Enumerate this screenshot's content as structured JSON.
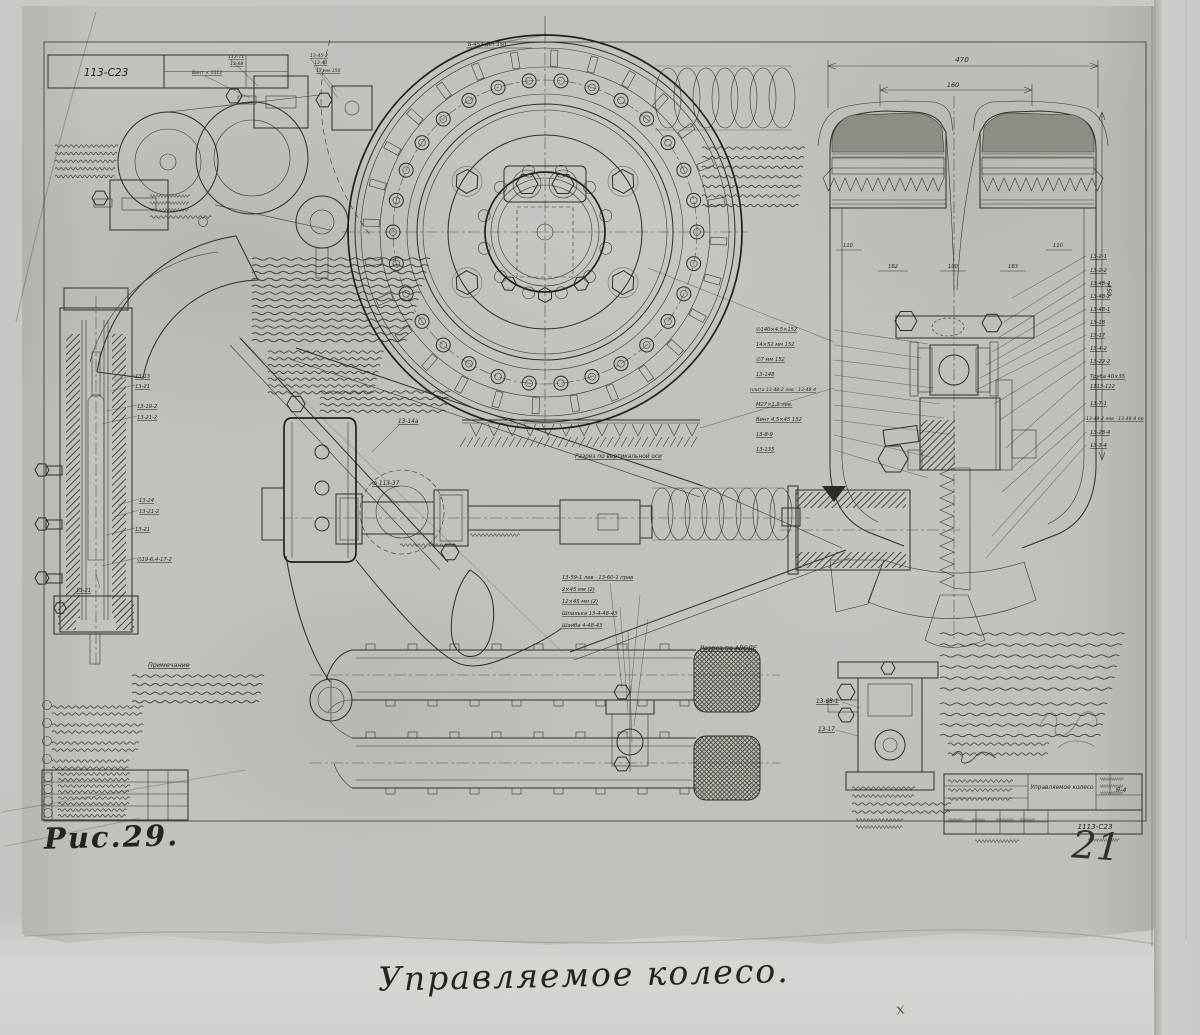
{
  "page": {
    "doc_number": "113-С23",
    "figure_label": "Рис.29.",
    "caption": "Управляемое колесо.",
    "page_number": "21",
    "corner_mark": "х",
    "top_note": "Б-453 дет 150"
  },
  "title_block": {
    "name": "Управляемое колесо",
    "group": "Я-4",
    "drawing_number": "1113-С23"
  },
  "dims": {
    "outer_width": "470",
    "inner_width": "160",
    "side_height": "450",
    "row": [
      "110",
      "162",
      "100",
      "163",
      "110"
    ]
  },
  "labels": {
    "section_abcde": "Разрез по АВСДЕ",
    "section_vertical": "Разрез по вертикальной оси",
    "note_title": "Примечание",
    "knuckle_part": "13-14а",
    "knuckle_dia": "∅ 113-37",
    "detail_part1": "13-68-1",
    "detail_part2": "13-17"
  },
  "callouts": {
    "top_left": [
      "113-71",
      "13-68",
      "Винт × 1312",
      "13-45-2",
      "13-43",
      "17 мм 150"
    ],
    "left_section": [
      "13-13",
      "13-21",
      "13-19-2",
      "13-21-2",
      "13-24",
      "13-21-2",
      "13-21",
      "∅19-6,4-17-2",
      "13-21"
    ],
    "hub_list": [
      "∅140×4,5×152",
      "14×52 мм 152",
      "∅7 мм 152",
      "13-148",
      "плита 13-48-2 лев · 13-48-4",
      "М27×1,5 лев.",
      "Винт 4,5×45 152",
      "13-8-9",
      "13-135"
    ],
    "right_column": [
      "13-2-1",
      "13-2-2",
      "13-48-4",
      "13-48-2",
      "13-48-1",
      "13-18",
      "13-17",
      "13-4-2",
      "13-22-2",
      "Труба 40×35",
      "1113-112",
      "13-7-1",
      "13-48-2 лев · 13-48-4 пр",
      "13-28-4",
      "13-3-4"
    ],
    "fork_list": [
      "13-59-1 лев · 13-60-1 прав",
      "2×45 мм (2)",
      "12×45 мм (2)",
      "Шпилька 13-4-48-43",
      "Шайба 4-48-43"
    ]
  }
}
